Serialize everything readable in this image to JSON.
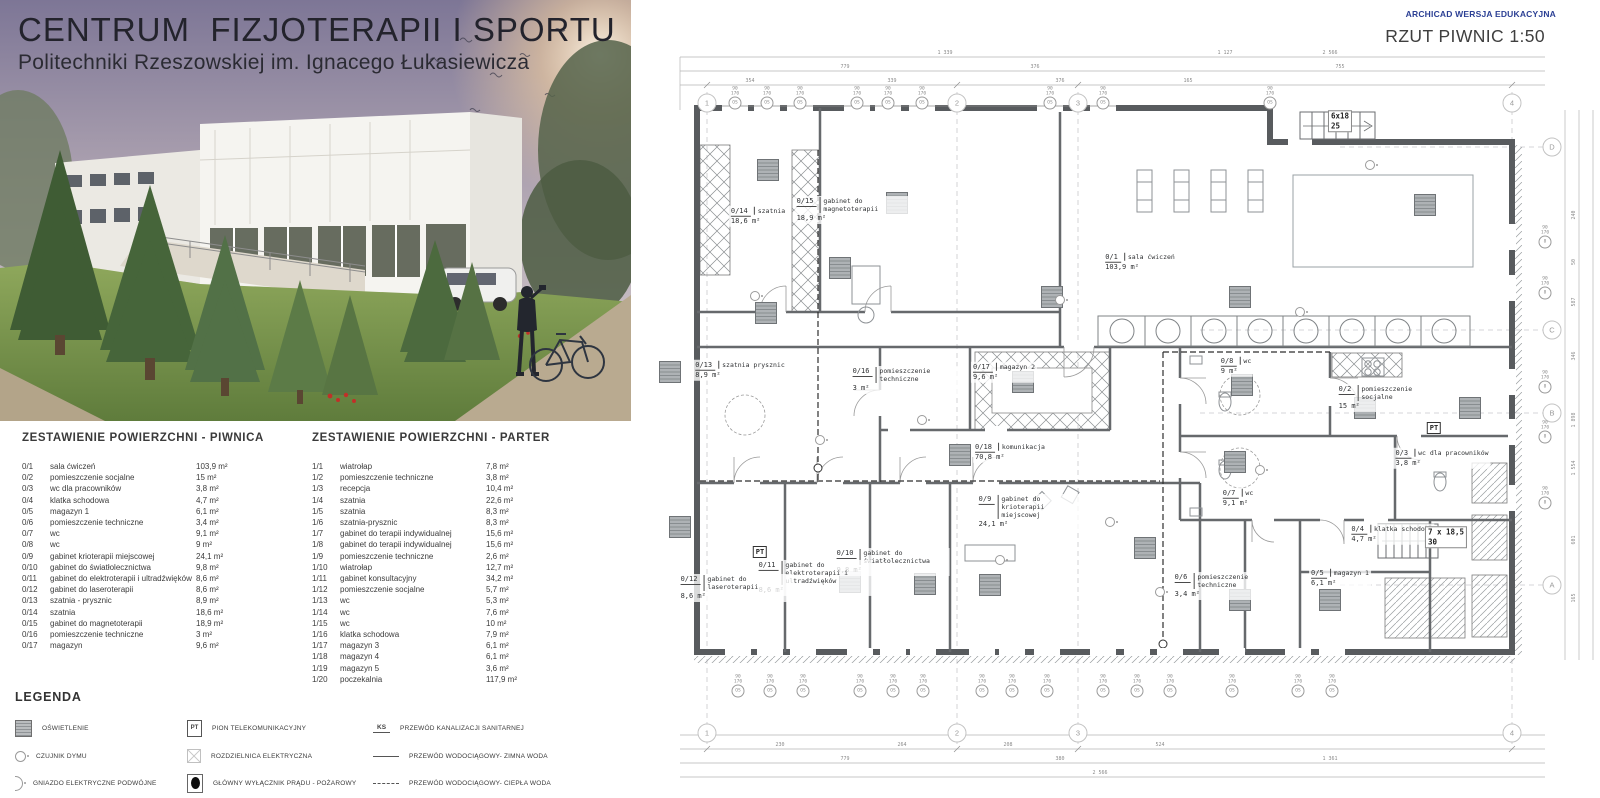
{
  "header": {
    "title": "CENTRUM  FIZJOTERAPII I SPORTU",
    "subtitle": "Politechniki Rzeszowskiej im. Ignacego Łukasiewicza"
  },
  "plan_header": {
    "credit": "ARCHICAD WERSJA EDUKACYJNA",
    "title": "RZUT PIWNIC 1:50",
    "credit_color": "#2b3f94"
  },
  "tables": {
    "piwnica": {
      "title": "ZESTAWIENIE POWIERZCHNI - PIWNICA",
      "rows": [
        {
          "id": "0/1",
          "name": "sala ćwiczeń",
          "area": "103,9 m²"
        },
        {
          "id": "0/2",
          "name": "pomieszczenie socjalne",
          "area": "15 m²"
        },
        {
          "id": "0/3",
          "name": "wc dla pracowników",
          "area": "3,8 m²"
        },
        {
          "id": "0/4",
          "name": "klatka schodowa",
          "area": "4,7 m²"
        },
        {
          "id": "0/5",
          "name": "magazyn 1",
          "area": "6,1 m²"
        },
        {
          "id": "0/6",
          "name": "pomieszczenie techniczne",
          "area": "3,4 m²"
        },
        {
          "id": "0/7",
          "name": "wc",
          "area": "9,1 m²"
        },
        {
          "id": "0/8",
          "name": "wc",
          "area": "9 m²"
        },
        {
          "id": "0/9",
          "name": "gabinet krioterapii miejscowej",
          "area": "24,1 m²"
        },
        {
          "id": "0/10",
          "name": "gabinet do światłolecznictwa",
          "area": "9,8 m²"
        },
        {
          "id": "0/11",
          "name": "gabinet do elektroterapii i ultradźwięków",
          "area": "8,6 m²"
        },
        {
          "id": "0/12",
          "name": "gabinet do laseroterapii",
          "area": "8,6 m²"
        },
        {
          "id": "0/13",
          "name": "szatnia - prysznic",
          "area": "8,9 m²"
        },
        {
          "id": "0/14",
          "name": "szatnia",
          "area": "18,6 m²"
        },
        {
          "id": "0/15",
          "name": "gabinet do magnetoterapii",
          "area": "18,9 m²"
        },
        {
          "id": "0/16",
          "name": "pomieszczenie techniczne",
          "area": "3 m²"
        },
        {
          "id": "0/17",
          "name": "magazyn",
          "area": "9,6 m²"
        }
      ]
    },
    "parter": {
      "title": "ZESTAWIENIE POWIERZCHNI - PARTER",
      "rows": [
        {
          "id": "1/1",
          "name": "wiatrołap",
          "area": "7,8 m²"
        },
        {
          "id": "1/2",
          "name": "pomieszczenie techniczne",
          "area": "3,8 m²"
        },
        {
          "id": "1/3",
          "name": "recepcja",
          "area": "10,4 m²"
        },
        {
          "id": "1/4",
          "name": "szatnia",
          "area": "22,6 m²"
        },
        {
          "id": "1/5",
          "name": "szatnia",
          "area": "8,3 m²"
        },
        {
          "id": "1/6",
          "name": "szatnia-prysznic",
          "area": "8,3 m²"
        },
        {
          "id": "1/7",
          "name": "gabinet do terapii indywidualnej",
          "area": "15,6 m²"
        },
        {
          "id": "1/8",
          "name": "gabinet do terapii indywidualnej",
          "area": "15,6 m²"
        },
        {
          "id": "1/9",
          "name": "pomieszczenie techniczne",
          "area": "2,6 m²"
        },
        {
          "id": "1/10",
          "name": "wiatrołap",
          "area": "12,7 m²"
        },
        {
          "id": "1/11",
          "name": "gabinet konsultacyjny",
          "area": "34,2 m²"
        },
        {
          "id": "1/12",
          "name": "pomieszczenie socjalne",
          "area": "5,7 m²"
        },
        {
          "id": "1/13",
          "name": "wc",
          "area": "5,3 m²"
        },
        {
          "id": "1/14",
          "name": "wc",
          "area": "7,6 m²"
        },
        {
          "id": "1/15",
          "name": "wc",
          "area": "10 m²"
        },
        {
          "id": "1/16",
          "name": "klatka schodowa",
          "area": "7,9 m²"
        },
        {
          "id": "1/17",
          "name": "magazyn 3",
          "area": "6,1 m²"
        },
        {
          "id": "1/18",
          "name": "magazyn 4",
          "area": "6,1 m²"
        },
        {
          "id": "1/19",
          "name": "magazyn 5",
          "area": "3,6 m²"
        },
        {
          "id": "1/20",
          "name": "poczekalnia",
          "area": "117,9 m²"
        }
      ]
    }
  },
  "legend": {
    "title": "LEGENDA",
    "items": [
      {
        "icon": "lighting",
        "label": "OŚWIETLENIE"
      },
      {
        "icon": "smoke-detector",
        "label": "CZUJNIK DYMU"
      },
      {
        "icon": "double-socket",
        "label": "GNIAZDO ELEKTRYCZNE PODWÓJNE"
      },
      {
        "icon": "pt",
        "icon_text": "PT",
        "label": "PION TELEKOMUNIKACYJNY"
      },
      {
        "icon": "panel",
        "label": "ROZDZIELNICA ELEKTRYCZNA"
      },
      {
        "icon": "main-switch",
        "label": "GŁÓWNY WYŁĄCZNIK PRĄDU - POŻAROWY"
      },
      {
        "icon": "ks",
        "icon_text": "KS",
        "label": "PRZEWÓD KANALIZACJI SANITARNEJ"
      },
      {
        "icon": "cold-water",
        "label": "PRZEWÓD WODOCIĄGOWY- ZIMNA WODA"
      },
      {
        "icon": "hot-water",
        "label": "PRZEWÓD WODOCIĄGOWY- CIEPŁA WODA"
      }
    ]
  },
  "plan": {
    "pt_label": "PT",
    "window_label": "OS",
    "window_label_right": "8",
    "window_dim1": "90",
    "window_dim2": "170",
    "grid_cols": [
      {
        "label": "1",
        "x": 67
      },
      {
        "label": "2",
        "x": 317
      },
      {
        "label": "3",
        "x": 438
      },
      {
        "label": "4",
        "x": 872
      }
    ],
    "grid_rows": [
      {
        "label": "D",
        "y": 147
      },
      {
        "label": "C",
        "y": 330
      },
      {
        "label": "B",
        "y": 413
      },
      {
        "label": "A",
        "y": 585
      }
    ],
    "rooms": [
      {
        "id": "0/1",
        "name": "sala ćwiczeń",
        "area": "103,9 m²",
        "x": 500,
        "y": 262
      },
      {
        "id": "0/2",
        "name": "pomieszczenie socjalne",
        "area": "15 m²",
        "x": 752,
        "y": 398
      },
      {
        "id": "0/3",
        "name": "wc dla pracowników",
        "area": "3,8 m²",
        "x": 802,
        "y": 458
      },
      {
        "id": "0/4",
        "name": "klatka schodowa",
        "area": "4,7 m²",
        "x": 752,
        "y": 534
      },
      {
        "id": "0/5",
        "name": "magazyn 1",
        "area": "6,1 m²",
        "x": 700,
        "y": 578
      },
      {
        "id": "0/6",
        "name": "pomieszczenie techniczne",
        "area": "3,4 m²",
        "x": 588,
        "y": 586
      },
      {
        "id": "0/7",
        "name": "wc",
        "area": "9,1 m²",
        "x": 598,
        "y": 498
      },
      {
        "id": "0/8",
        "name": "wc",
        "area": "9 m²",
        "x": 596,
        "y": 366
      },
      {
        "id": "0/9",
        "name": "gabinet do krioterapii miejscowej",
        "area": "24,1 m²",
        "x": 392,
        "y": 512
      },
      {
        "id": "0/10",
        "name": "gabinet do światłolecznictwa",
        "area": "9,8 m²",
        "x": 252,
        "y": 562
      },
      {
        "id": "0/11",
        "name": "gabinet do elektroterapii i ultradźwięków",
        "area": "8,6 m²",
        "x": 174,
        "y": 578
      },
      {
        "id": "0/12",
        "name": "gabinet do laseroterapii",
        "area": "8,6 m²",
        "x": 96,
        "y": 588
      },
      {
        "id": "0/13",
        "name": "szatnia prysznic",
        "area": "8,9 m²",
        "x": 100,
        "y": 370
      },
      {
        "id": "0/14",
        "name": "szatnia",
        "area": "18,6 m²",
        "x": 118,
        "y": 216
      },
      {
        "id": "0/15",
        "name": "gabinet do magnetoterapii",
        "area": "18,9 m²",
        "x": 212,
        "y": 210
      },
      {
        "id": "0/16",
        "name": "pomieszczenie techniczne",
        "area": "3 m²",
        "x": 268,
        "y": 380
      },
      {
        "id": "0/17",
        "name": "magazyn 2",
        "area": "9,6 m²",
        "x": 364,
        "y": 372
      },
      {
        "id": "0/18",
        "name": "komunikacja",
        "area": "70,8 m²",
        "x": 370,
        "y": 452
      }
    ],
    "stairs": [
      {
        "l1": "6x18",
        "l2": "25",
        "x": 700,
        "y": 121
      },
      {
        "l1": "7 x 18,5",
        "l2": "30",
        "x": 806,
        "y": 537
      }
    ],
    "pt_markers": [
      {
        "x": 120,
        "y": 552
      },
      {
        "x": 794,
        "y": 428
      }
    ],
    "windows_top": [
      {
        "x": 95
      },
      {
        "x": 127
      },
      {
        "x": 160
      },
      {
        "x": 217
      },
      {
        "x": 248
      },
      {
        "x": 282
      },
      {
        "x": 410
      },
      {
        "x": 463
      },
      {
        "x": 630
      }
    ],
    "windows_bottom": [
      {
        "x": 98
      },
      {
        "x": 130
      },
      {
        "x": 163
      },
      {
        "x": 220
      },
      {
        "x": 253
      },
      {
        "x": 283
      },
      {
        "x": 342
      },
      {
        "x": 372
      },
      {
        "x": 407
      },
      {
        "x": 463
      },
      {
        "x": 497
      },
      {
        "x": 530
      },
      {
        "x": 592
      },
      {
        "x": 658
      },
      {
        "x": 692
      }
    ],
    "windows_right": [
      {
        "y": 237
      },
      {
        "y": 288
      },
      {
        "y": 382
      },
      {
        "y": 432
      },
      {
        "y": 498
      }
    ],
    "lights": [
      {
        "x": 128,
        "y": 170
      },
      {
        "x": 257,
        "y": 203
      },
      {
        "x": 200,
        "y": 268
      },
      {
        "x": 126,
        "y": 313
      },
      {
        "x": 412,
        "y": 297
      },
      {
        "x": 600,
        "y": 297
      },
      {
        "x": 383,
        "y": 382
      },
      {
        "x": 602,
        "y": 385
      },
      {
        "x": 210,
        "y": 582
      },
      {
        "x": 285,
        "y": 584
      },
      {
        "x": 350,
        "y": 585
      },
      {
        "x": 320,
        "y": 455
      },
      {
        "x": 505,
        "y": 548
      },
      {
        "x": 600,
        "y": 600
      },
      {
        "x": 690,
        "y": 600
      },
      {
        "x": 725,
        "y": 408
      },
      {
        "x": 830,
        "y": 408
      },
      {
        "x": 785,
        "y": 205
      },
      {
        "x": 595,
        "y": 462
      },
      {
        "x": 40,
        "y": 527
      },
      {
        "x": 30,
        "y": 372
      }
    ],
    "smoke": [
      {
        "x": 115,
        "y": 296
      },
      {
        "x": 420,
        "y": 300
      },
      {
        "x": 282,
        "y": 420
      },
      {
        "x": 660,
        "y": 312
      },
      {
        "x": 470,
        "y": 522
      },
      {
        "x": 620,
        "y": 470
      },
      {
        "x": 520,
        "y": 592
      },
      {
        "x": 180,
        "y": 440
      },
      {
        "x": 730,
        "y": 165
      },
      {
        "x": 360,
        "y": 560
      }
    ],
    "dims_top": [
      {
        "t": "2 566",
        "x": 690,
        "y": 53
      },
      {
        "t": "1 127",
        "x": 585,
        "y": 53
      },
      {
        "t": "1 339",
        "x": 305,
        "y": 53
      },
      {
        "t": "779",
        "x": 205,
        "y": 67
      },
      {
        "t": "376",
        "x": 395,
        "y": 67
      },
      {
        "t": "755",
        "x": 700,
        "y": 67
      },
      {
        "t": "354",
        "x": 110,
        "y": 81
      },
      {
        "t": "339",
        "x": 252,
        "y": 81
      },
      {
        "t": "376",
        "x": 420,
        "y": 81
      },
      {
        "t": "165",
        "x": 548,
        "y": 81
      }
    ],
    "dims_bottom": [
      {
        "t": "230",
        "x": 140,
        "y": 745
      },
      {
        "t": "264",
        "x": 262,
        "y": 745
      },
      {
        "t": "208",
        "x": 368,
        "y": 745
      },
      {
        "t": "524",
        "x": 520,
        "y": 745
      },
      {
        "t": "779",
        "x": 205,
        "y": 759
      },
      {
        "t": "380",
        "x": 420,
        "y": 759
      },
      {
        "t": "1 361",
        "x": 690,
        "y": 759
      },
      {
        "t": "2 566",
        "x": 460,
        "y": 773
      }
    ],
    "dims_right": [
      {
        "t": "240",
        "y": 215
      },
      {
        "t": "50",
        "y": 262
      },
      {
        "t": "587",
        "y": 302
      },
      {
        "t": "346",
        "y": 356
      },
      {
        "t": "1 898",
        "y": 420
      },
      {
        "t": "1 554",
        "y": 468
      },
      {
        "t": "601",
        "y": 540
      },
      {
        "t": "165",
        "y": 598
      }
    ]
  }
}
